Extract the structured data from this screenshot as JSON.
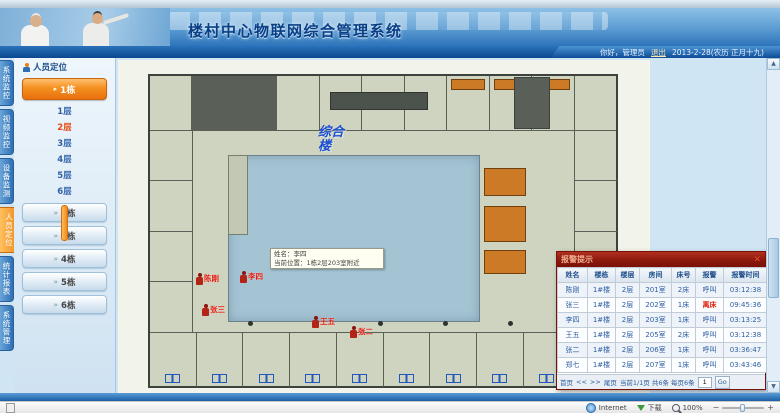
{
  "header": {
    "title": "楼村中心物联网综合管理系统",
    "greeting": "你好，管理员",
    "logout": "退出",
    "date": "2013-2-28(农历 正月十九)"
  },
  "nav_tabs": [
    {
      "label": "系统监控"
    },
    {
      "label": "视频监控"
    },
    {
      "label": "设备监测"
    },
    {
      "label": "人员定位"
    },
    {
      "label": "统计报表"
    },
    {
      "label": "系统管理"
    }
  ],
  "sidebar": {
    "panel_title": "人员定位",
    "active_building": "1栋",
    "active_floor": "2层",
    "floors": [
      "1层",
      "2层",
      "3层",
      "4层",
      "5层",
      "6层"
    ],
    "buildings": [
      "2栋",
      "3栋",
      "4栋",
      "5栋",
      "6栋"
    ]
  },
  "floorplan": {
    "building_label": "综合楼",
    "tooltip": {
      "line1": "姓名：李四",
      "line2": "当前位置：1栋2层203室附近"
    },
    "markers": [
      {
        "name": "陈刚"
      },
      {
        "name": "李四"
      },
      {
        "name": "张三"
      },
      {
        "name": "王五"
      },
      {
        "name": "张二"
      }
    ]
  },
  "alarm_panel": {
    "title": "报警提示",
    "close": "✕",
    "columns": [
      "姓名",
      "楼栋",
      "楼层",
      "房间",
      "床号",
      "报警",
      "报警时间"
    ],
    "rows": [
      [
        "陈刚",
        "1#楼",
        "2层",
        "201室",
        "2床",
        "呼叫",
        "03:12:38"
      ],
      [
        "张三",
        "1#楼",
        "2层",
        "202室",
        "1床",
        "离床",
        "09:45:36"
      ],
      [
        "李四",
        "1#楼",
        "2层",
        "203室",
        "1床",
        "呼叫",
        "03:13:25"
      ],
      [
        "王五",
        "1#楼",
        "2层",
        "205室",
        "2床",
        "呼叫",
        "03:12:38"
      ],
      [
        "张二",
        "1#楼",
        "2层",
        "206室",
        "1床",
        "呼叫",
        "03:36:47"
      ],
      [
        "郑七",
        "1#楼",
        "2层",
        "207室",
        "1床",
        "呼叫",
        "03:43:46"
      ]
    ],
    "pagination": {
      "first": "首页",
      "prev": "<<",
      "next": ">>",
      "last": "尾页",
      "info": "当前1/1页 共6条 每页6条",
      "page": "1",
      "go": "Go"
    }
  },
  "statusbar": {
    "zone": "Internet",
    "download": "下载",
    "zoom": "100%"
  },
  "colors": {
    "header_blue": "#2e74ba",
    "accent_orange": "#ef8c1a",
    "alarm_header_red": "#8a170c",
    "alert_text_red": "#e02410",
    "courtyard_blue": "#a4c4d4"
  }
}
